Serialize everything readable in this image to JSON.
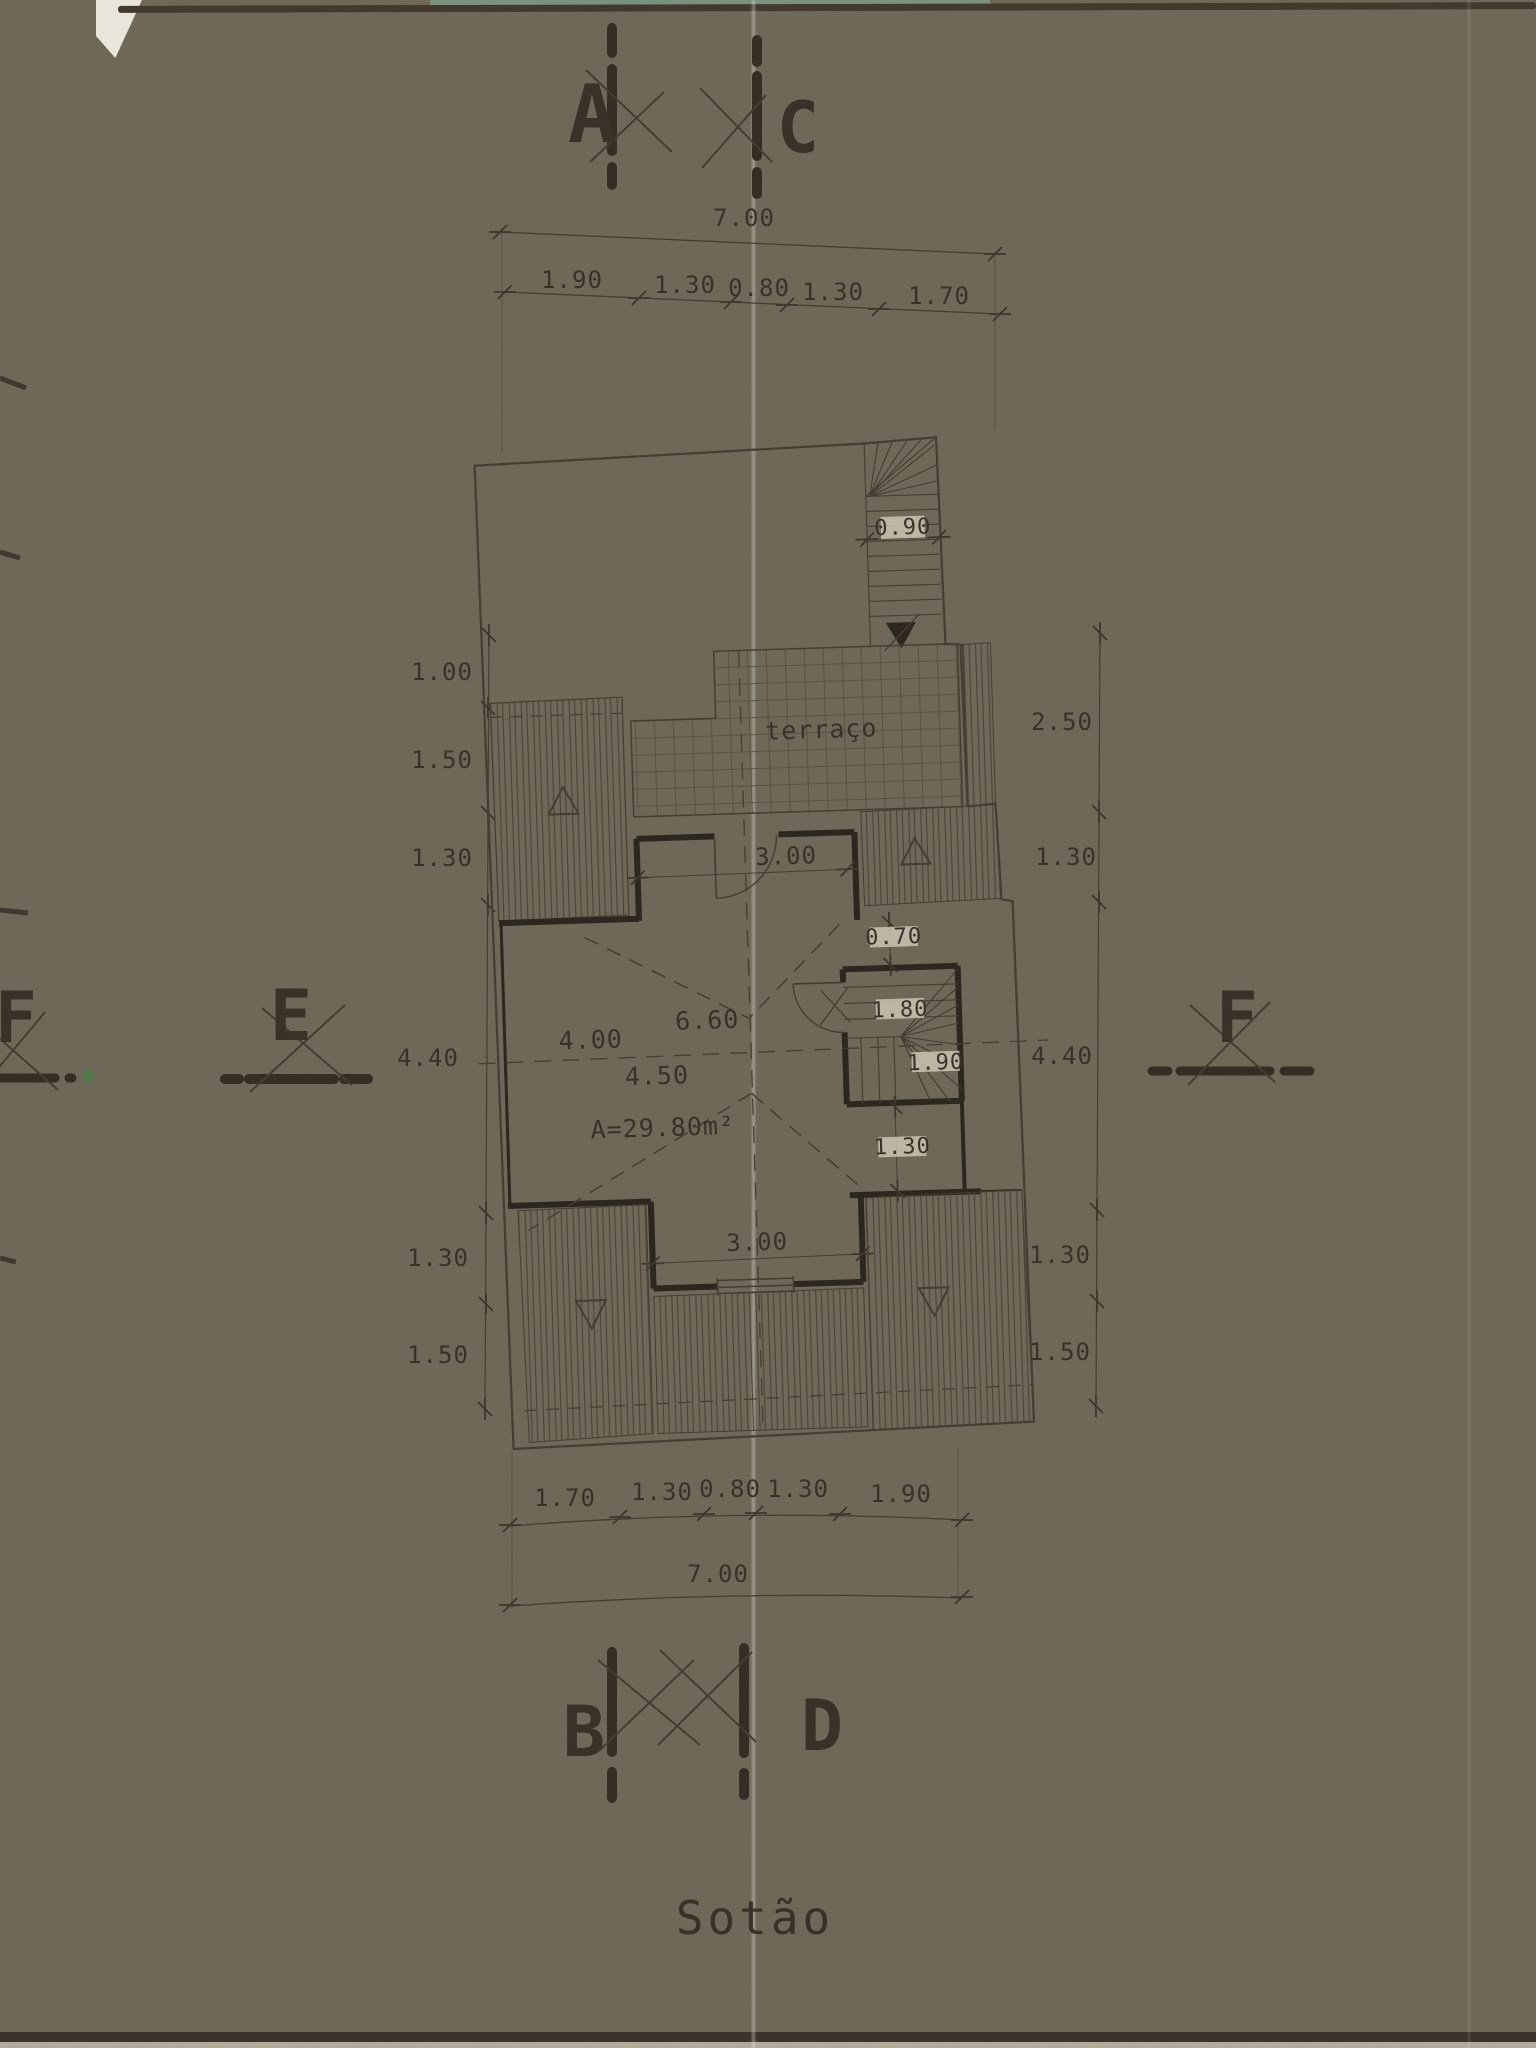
{
  "page": {
    "title": "Sotão"
  },
  "markers": {
    "a": "A",
    "c": "C",
    "b": "B",
    "d": "D",
    "e": "E",
    "f_left": "F",
    "f_right": "F"
  },
  "plan": {
    "terrace_label": "terraço",
    "area_label": "A=29.80m²",
    "dims": {
      "stair_width": "0.90",
      "upper_door": "3.00",
      "niche": "0.70",
      "room_width": "6.60",
      "room_left": "4.00",
      "room_center": "4.50",
      "stair_run_a": "1.80",
      "stair_run_b": "1.90",
      "stair_landing": "1.30",
      "lower_door": "3.00"
    }
  },
  "dims": {
    "top_total": "7.00",
    "top_segments": [
      "1.90",
      "1.30",
      "0.80",
      "1.30",
      "1.70"
    ],
    "left_chain": [
      "1.00",
      "1.50",
      "1.30",
      "4.40",
      "1.30",
      "1.50"
    ],
    "right_chain": [
      "2.50",
      "1.30",
      "4.40",
      "1.30",
      "1.50"
    ],
    "bottom_segments": [
      "1.70",
      "1.30",
      "0.80",
      "1.30",
      "1.90"
    ],
    "bottom_total": "7.00"
  },
  "colors": {
    "ink": "#3c362c",
    "wall": "#2b261e",
    "paper": "#c9c5b2",
    "teal_edge": "#7d9a85"
  }
}
